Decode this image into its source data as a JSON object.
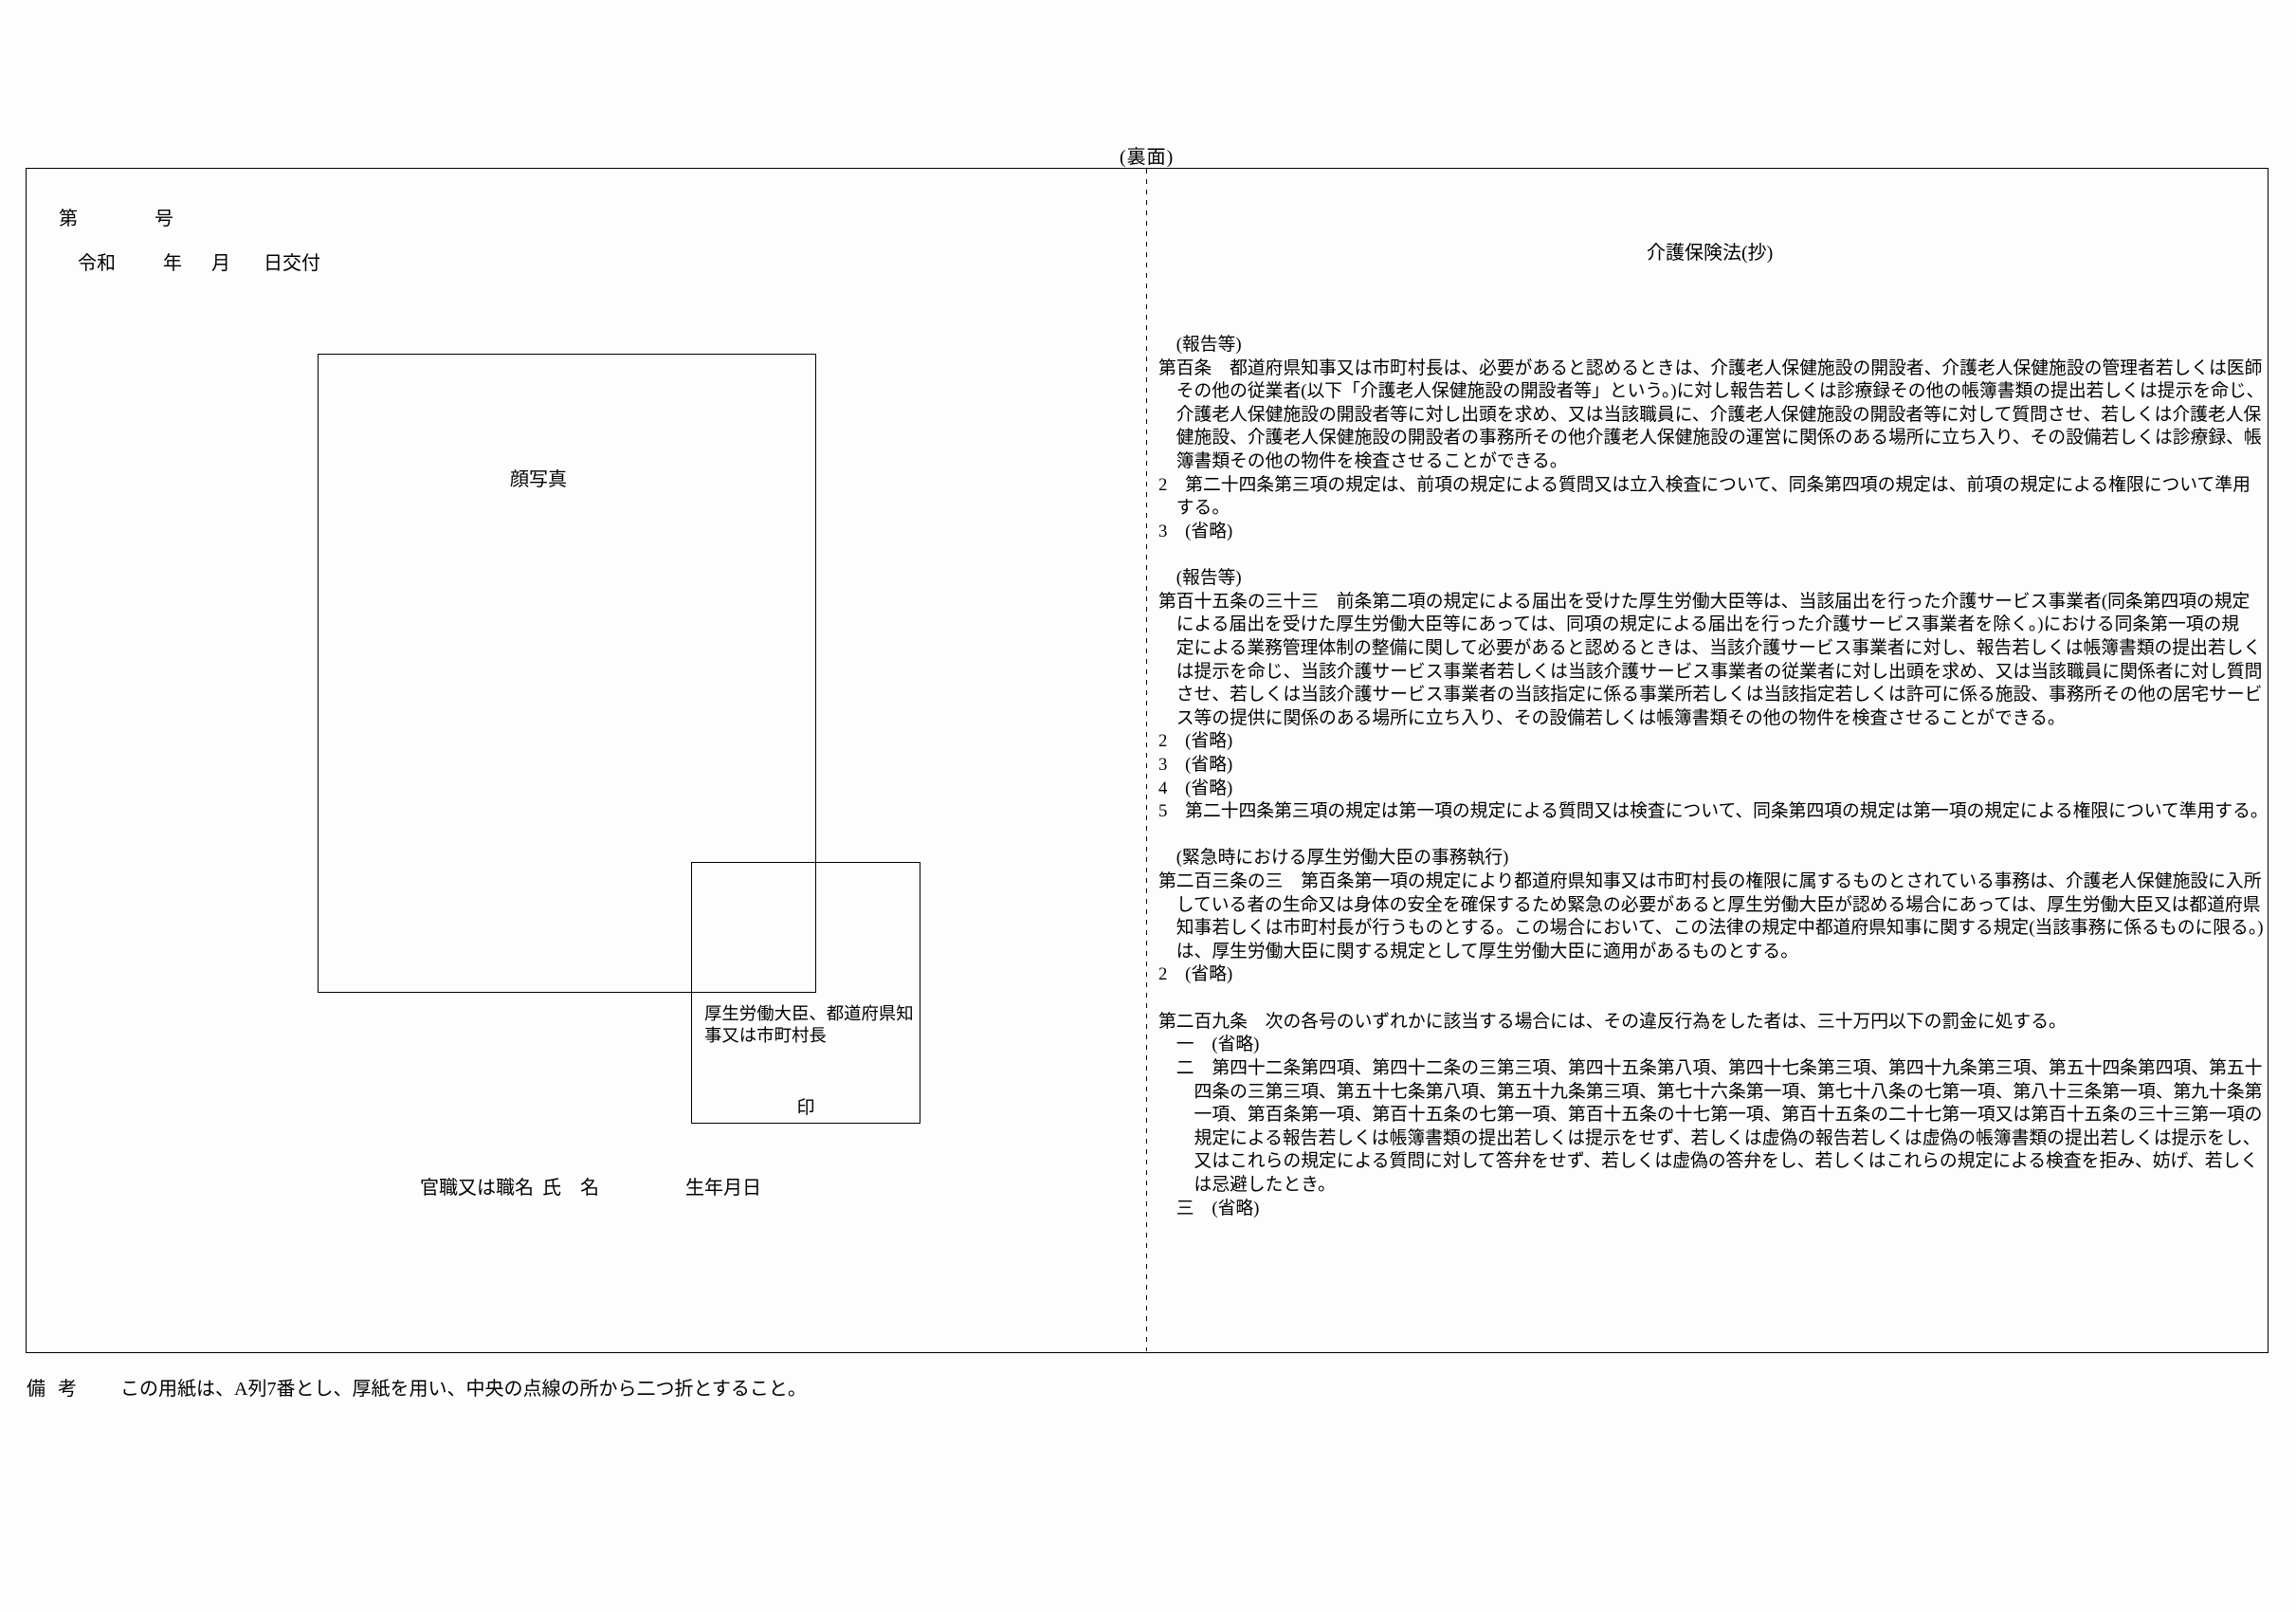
{
  "page": {
    "side_label": "(裏面)",
    "remark": {
      "label": "備考",
      "text": "この用紙は、A列7番とし、厚紙を用い、中央の点線の所から二つ折とすること。"
    }
  },
  "certificate": {
    "number_line": {
      "prefix": "第",
      "suffix": "号"
    },
    "issue_date_line": {
      "era": "令和",
      "year_label": "年",
      "month_label": "月",
      "day_label": "日交付"
    },
    "photo_label": "顔写真",
    "issuer_box": {
      "issuer": "厚生労働大臣、都道府県知事又は市町村長",
      "seal_label": "印"
    },
    "signature_row": {
      "title_label": "官職又は職名",
      "name_label": "氏　名",
      "birth_label": "生年月日"
    }
  },
  "law": {
    "title": "介護保険法(抄)",
    "lines": [
      "　(報告等)",
      "第百条　都道府県知事又は市町村長は、必要があると認めるときは、介護老人保健施設の開設者、介護老人保健施設の管理者若しくは医師",
      "　その他の従業者(以下「介護老人保健施設の開設者等」という。)に対し報告若しくは診療録その他の帳簿書類の提出若しくは提示を命じ、",
      "　介護老人保健施設の開設者等に対し出頭を求め、又は当該職員に、介護老人保健施設の開設者等に対して質問させ、若しくは介護老人保",
      "　健施設、介護老人保健施設の開設者の事務所その他介護老人保健施設の運営に関係のある場所に立ち入り、その設備若しくは診療録、帳",
      "　簿書類その他の物件を検査させることができる。",
      "2　第二十四条第三項の規定は、前項の規定による質問又は立入検査について、同条第四項の規定は、前項の規定による権限について準用",
      "　する。",
      "3　(省略)",
      "",
      "　(報告等)",
      "第百十五条の三十三　前条第二項の規定による届出を受けた厚生労働大臣等は、当該届出を行った介護サービス事業者(同条第四項の規定",
      "　による届出を受けた厚生労働大臣等にあっては、同項の規定による届出を行った介護サービス事業者を除く。)における同条第一項の規",
      "　定による業務管理体制の整備に関して必要があると認めるときは、当該介護サービス事業者に対し、報告若しくは帳簿書類の提出若しく",
      "　は提示を命じ、当該介護サービス事業者若しくは当該介護サービス事業者の従業者に対し出頭を求め、又は当該職員に関係者に対し質問",
      "　させ、若しくは当該介護サービス事業者の当該指定に係る事業所若しくは当該指定若しくは許可に係る施設、事務所その他の居宅サービ",
      "　ス等の提供に関係のある場所に立ち入り、その設備若しくは帳簿書類その他の物件を検査させることができる。",
      "2　(省略)",
      "3　(省略)",
      "4　(省略)",
      "5　第二十四条第三項の規定は第一項の規定による質問又は検査について、同条第四項の規定は第一項の規定による権限について準用する。",
      "",
      "　(緊急時における厚生労働大臣の事務執行)",
      "第二百三条の三　第百条第一項の規定により都道府県知事又は市町村長の権限に属するものとされている事務は、介護老人保健施設に入所",
      "　している者の生命又は身体の安全を確保するため緊急の必要があると厚生労働大臣が認める場合にあっては、厚生労働大臣又は都道府県",
      "　知事若しくは市町村長が行うものとする。この場合において、この法律の規定中都道府県知事に関する規定(当該事務に係るものに限る。)",
      "　は、厚生労働大臣に関する規定として厚生労働大臣に適用があるものとする。",
      "2　(省略)",
      "",
      "第二百九条　次の各号のいずれかに該当する場合には、その違反行為をした者は、三十万円以下の罰金に処する。",
      "　一　(省略)",
      "　二　第四十二条第四項、第四十二条の三第三項、第四十五条第八項、第四十七条第三項、第四十九条第三項、第五十四条第四項、第五十",
      "　　四条の三第三項、第五十七条第八項、第五十九条第三項、第七十六条第一項、第七十八条の七第一項、第八十三条第一項、第九十条第",
      "　　一項、第百条第一項、第百十五条の七第一項、第百十五条の十七第一項、第百十五条の二十七第一項又は第百十五条の三十三第一項の",
      "　　規定による報告若しくは帳簿書類の提出若しくは提示をせず、若しくは虚偽の報告若しくは虚偽の帳簿書類の提出若しくは提示をし、",
      "　　又はこれらの規定による質問に対して答弁をせず、若しくは虚偽の答弁をし、若しくはこれらの規定による検査を拒み、妨げ、若しく",
      "　　は忌避したとき。",
      "　三　(省略)"
    ]
  }
}
